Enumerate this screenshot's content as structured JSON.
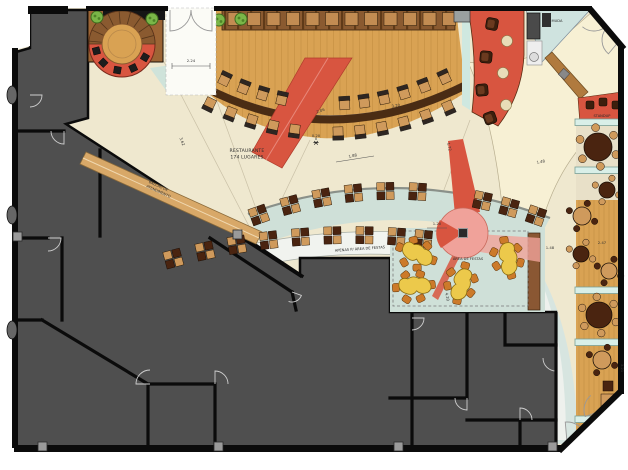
{
  "plan": {
    "labels": {
      "restaurante_l1": "RESTAURANTE",
      "restaurante_l2": "174 LUGARES",
      "balcao_l1": "BALCÃO DE",
      "balcao_l2": "ATENDIMENTO",
      "apenas": "APENAS P/ ÁREA DE FESTAS",
      "area_festas": "ÁREA DE FESTAS",
      "standup": "STANDUP",
      "service": "MUDA"
    },
    "dimensions": [
      "2.24",
      "0.20",
      "1.88",
      "1.72",
      "1.48",
      "1.20",
      "4.20",
      "1.48",
      "2.47",
      "3.21",
      "2.06",
      "3.20",
      "3.62"
    ],
    "palette": {
      "charcoal": "#4f4f4f",
      "wall": "#0b0b0b",
      "cream": "#efe8cf",
      "fan": "#f7f0d4",
      "teal": "#cfe0d8",
      "tealLight": "#d9efe8",
      "wood": "#d9a253",
      "woodDark": "#c08c40",
      "counter": "#4a2c14",
      "panel": "#8a5a30",
      "red": "#d85540",
      "salmon": "#f0a29a",
      "tan": "#cf9a5c",
      "darkchair": "#4a2410",
      "yellow": "#ecc94b",
      "orange": "#cc7a2a",
      "plant": "#7ab648"
    }
  }
}
